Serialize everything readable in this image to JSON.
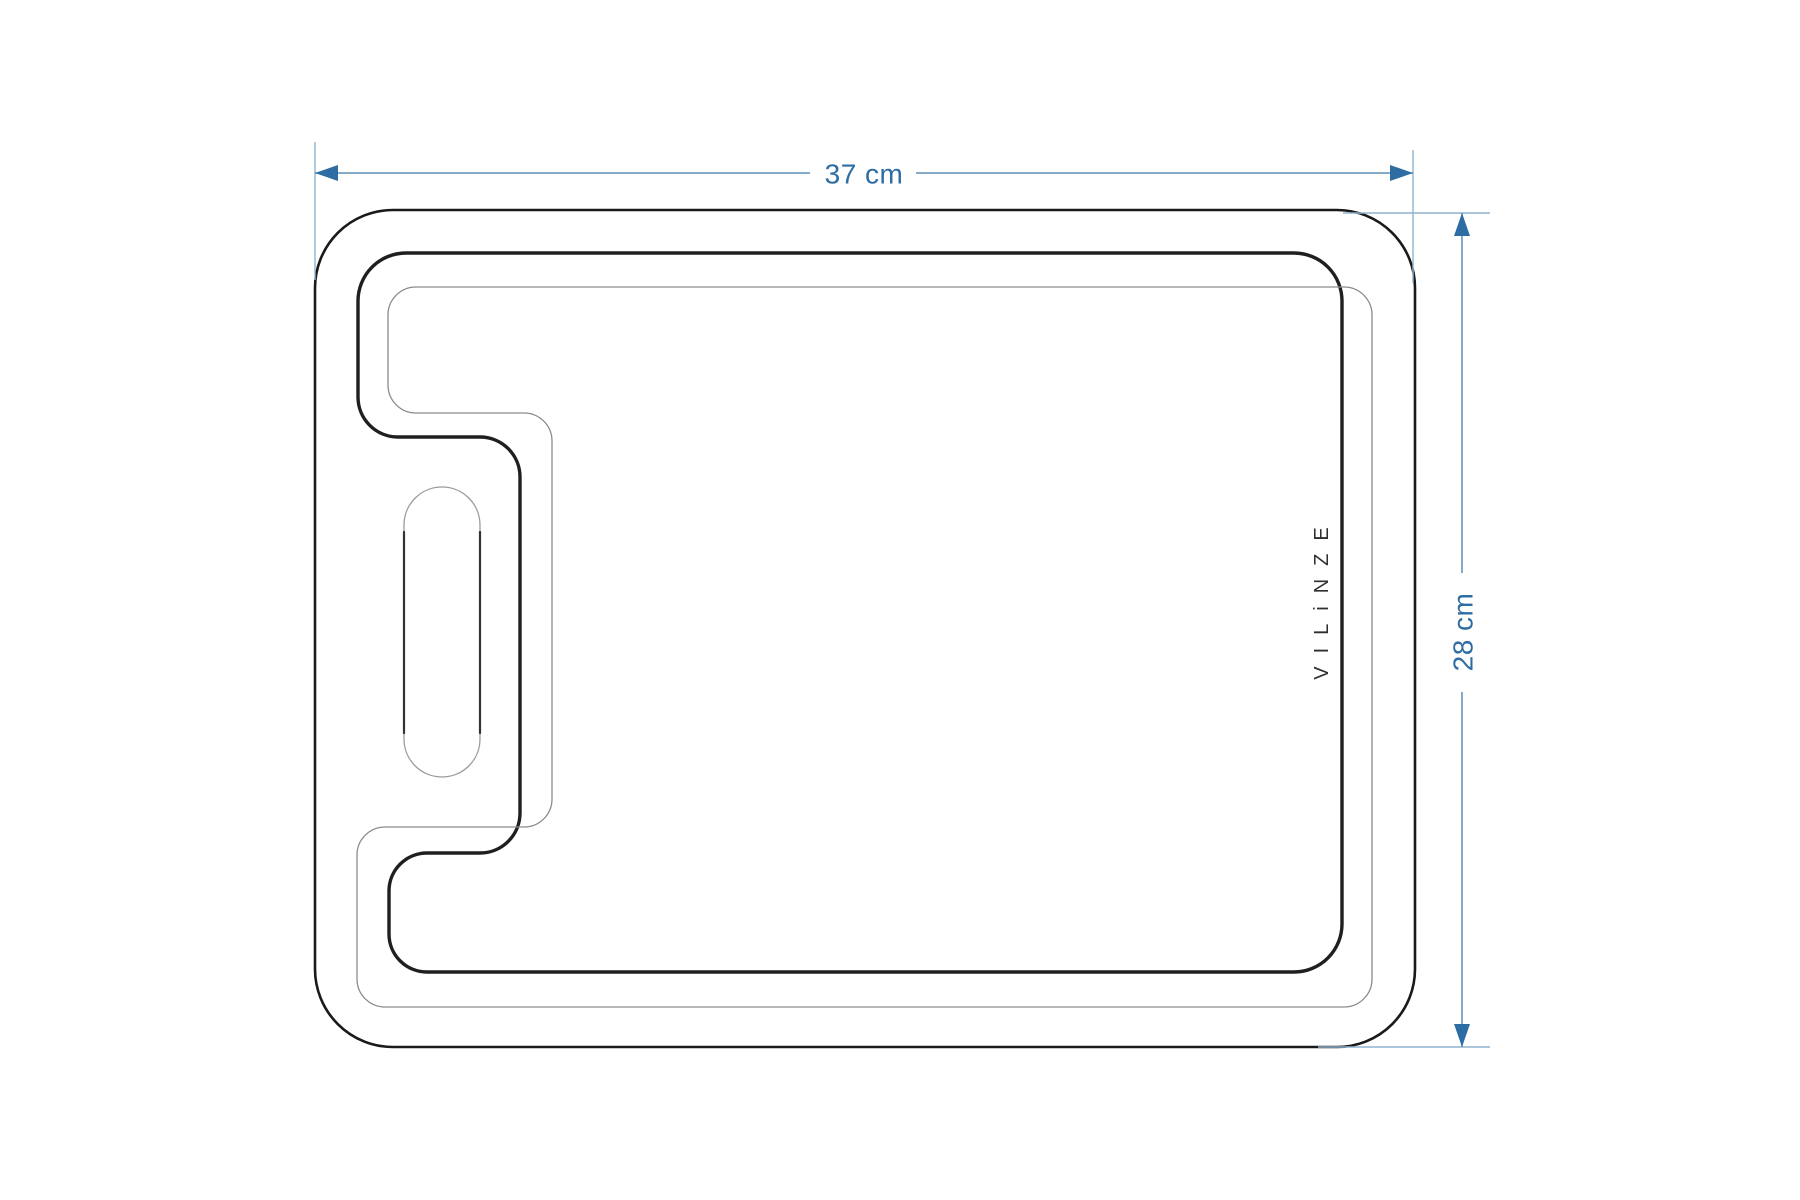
{
  "board": {
    "brand": "VILiNZE"
  },
  "dimensions": {
    "width_label": "37 cm",
    "height_label": "28 cm"
  },
  "icons": {
    "top_dimension": [
      "arrow-left-icon",
      "arrow-right-icon"
    ],
    "right_dimension": [
      "arrow-up-icon",
      "arrow-down-icon"
    ]
  },
  "colors": {
    "background": "#ffffff",
    "board_outline": "#1a1a1a",
    "groove_bold_line": "#1f1f1f",
    "groove_thin_line": "#8c8c8c",
    "handle_outline": "#9a9a9a",
    "handle_edge": "#333333",
    "brand_text": "#2f2f2f",
    "dimension_text": "#2d6da3",
    "dimension_line": "#5d8fb5",
    "extension_line": "#8fb3cf",
    "arrowhead": "#2d6da3"
  }
}
